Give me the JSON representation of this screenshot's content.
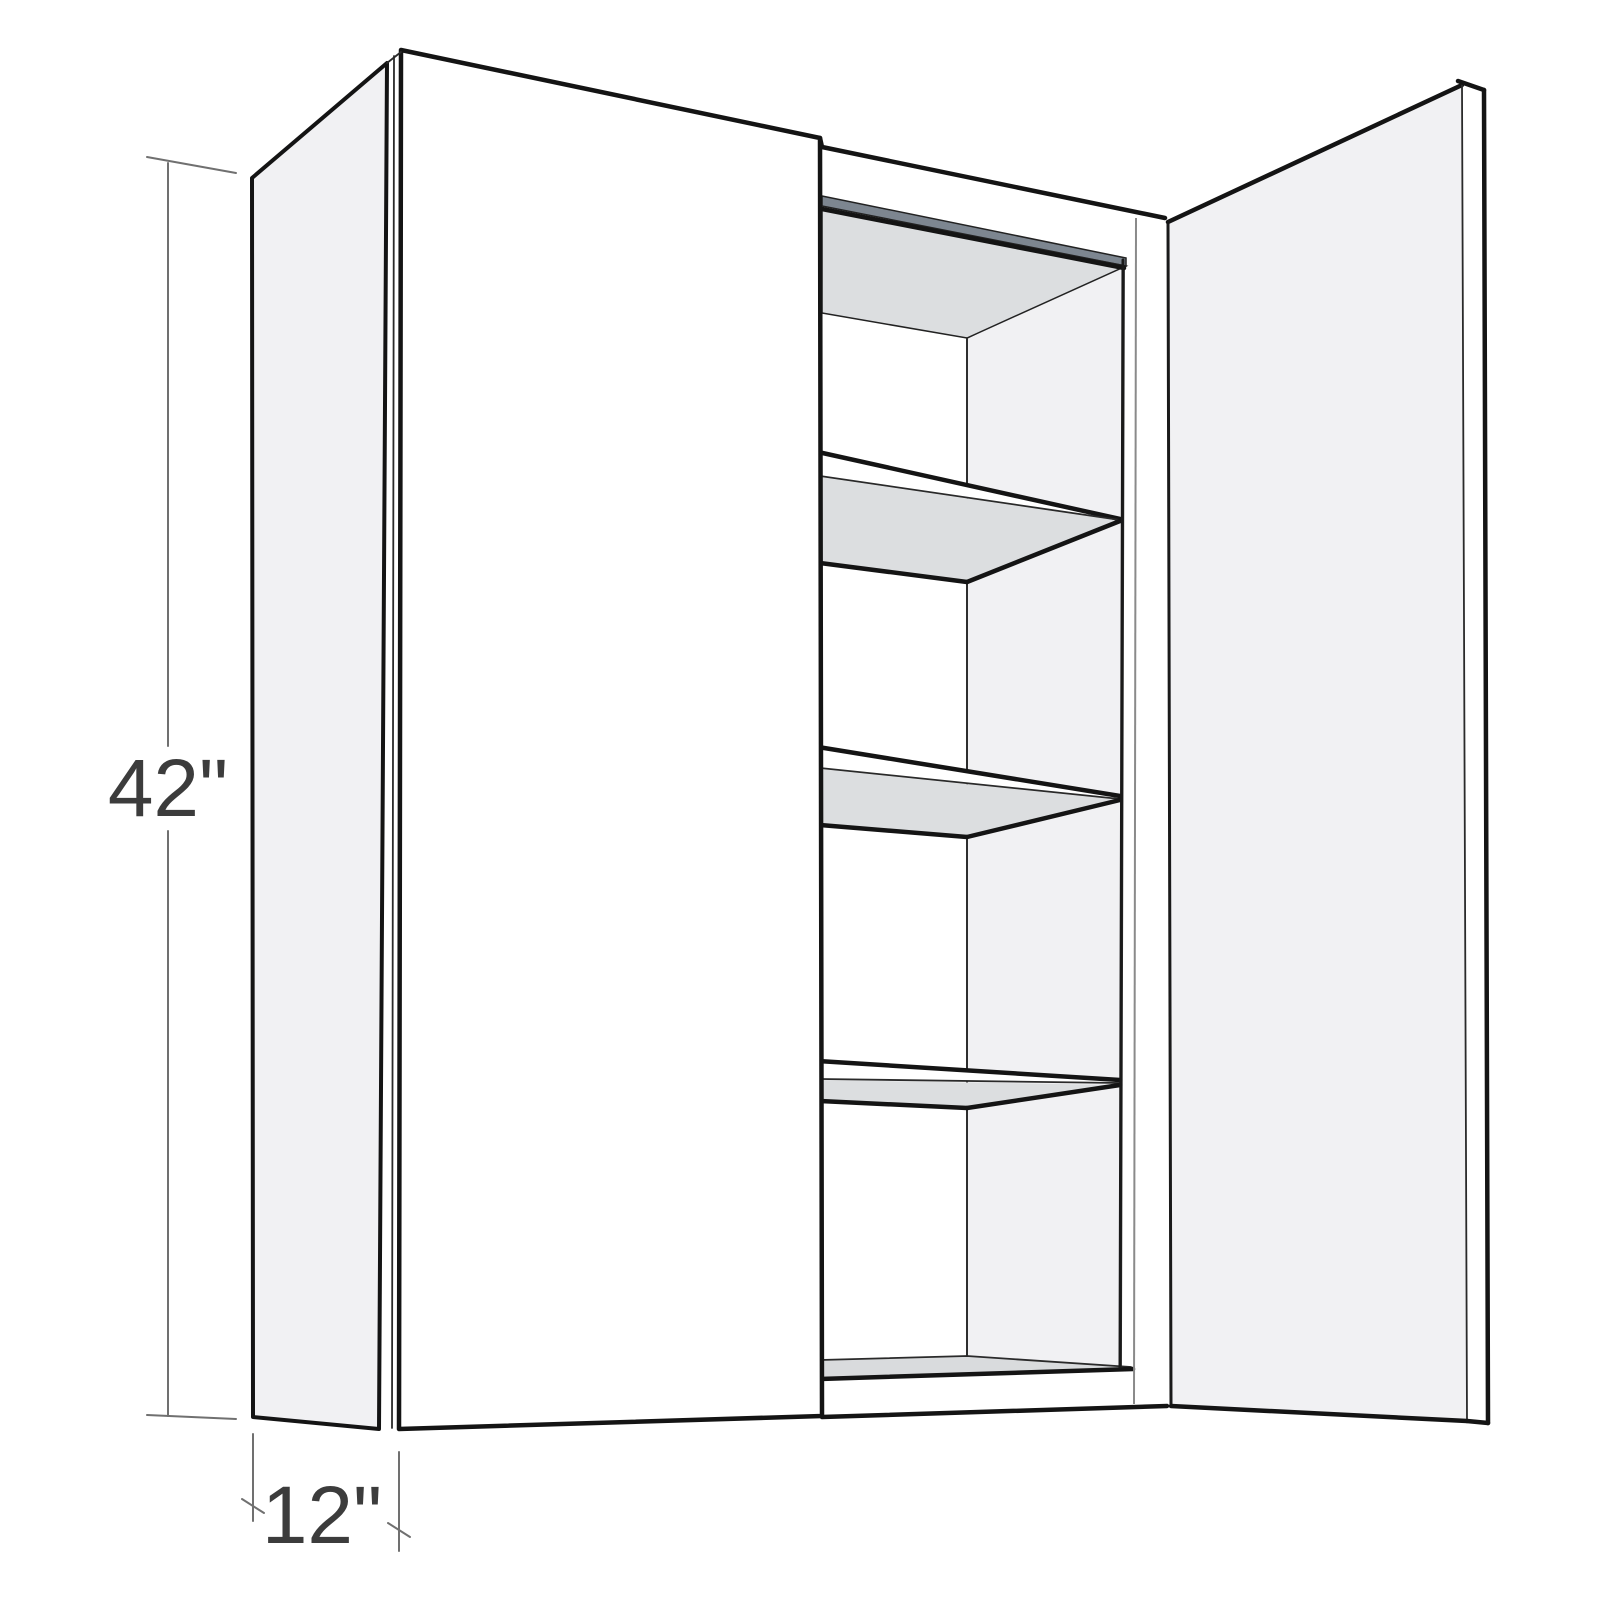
{
  "diagram": {
    "type": "product-dimension-illustration",
    "subject": "Two-door wall cabinet shown with left door closed, right door open, and three interior shelves",
    "dimensions": {
      "height": "42\"",
      "depth": "12\""
    },
    "shelf_count": 3,
    "colors": {
      "background": "#ffffff",
      "outline": "#141414",
      "panel_white": "#ffffff",
      "panel_light_gray": "#f1f1f3",
      "underside_gray": "#dcdee0",
      "top_rail_dark": "#7d8690",
      "dimension_line": "#707070",
      "dimension_text": "#3c3c3c"
    }
  }
}
